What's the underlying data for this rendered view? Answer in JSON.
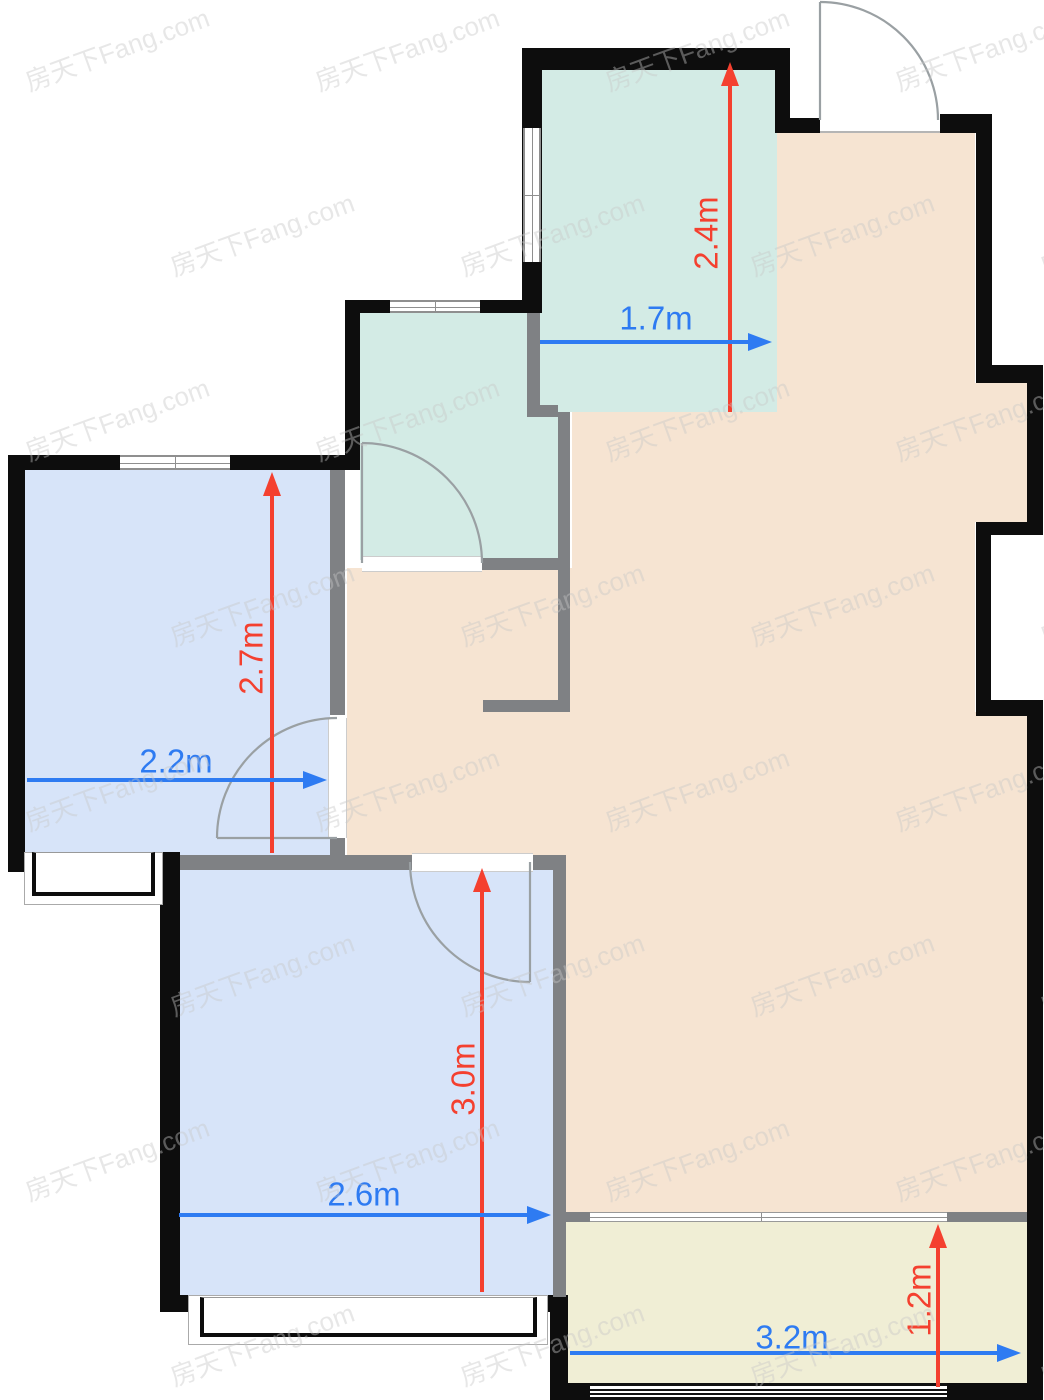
{
  "canvas": {
    "width": 1044,
    "height": 1400,
    "background": "#ffffff"
  },
  "palette": {
    "floor_blue": "#d7e4f9",
    "floor_teal": "#d3ebe5",
    "floor_beige": "#f6e4d2",
    "floor_yellow": "#f0eed5",
    "wall_black": "#0d0d0d",
    "wall_gray": "#7f8184",
    "frame_gray": "#8f8f8f",
    "door_gray": "#9aa0a3",
    "dim_red": "#f4402f",
    "dim_blue": "#2e7bf2"
  },
  "watermark": {
    "text": "房天下Fang.com",
    "font_size": 26,
    "color": "#c8c8c8",
    "opacity": 0.42,
    "rotation_deg": -20,
    "cols": [
      20,
      310,
      600,
      890
    ],
    "rows": [
      30,
      215,
      400,
      585,
      770,
      955,
      1140,
      1325
    ],
    "odd_row_offset": 145
  },
  "rooms": [
    {
      "name": "kitchen",
      "fill": "floor_teal",
      "rects": [
        [
          542,
          70,
          235,
          342
        ]
      ]
    },
    {
      "name": "bathroom",
      "fill": "floor_teal",
      "rects": [
        [
          360,
          313,
          198,
          247
        ]
      ]
    },
    {
      "name": "bedroom-left",
      "fill": "floor_blue",
      "rects": [
        [
          25,
          470,
          305,
          385
        ]
      ]
    },
    {
      "name": "bedroom-bottom",
      "fill": "floor_blue",
      "rects": [
        [
          180,
          870,
          373,
          425
        ]
      ]
    },
    {
      "name": "living-hall",
      "fill": "floor_beige",
      "rects": [
        [
          777,
          133,
          198,
          279
        ],
        [
          975,
          383,
          52,
          139
        ],
        [
          572,
          412,
          403,
          300
        ],
        [
          347,
          568,
          225,
          289
        ],
        [
          566,
          712,
          461,
          500
        ]
      ]
    },
    {
      "name": "balcony",
      "fill": "floor_yellow",
      "rects": [
        [
          566,
          1222,
          461,
          163
        ]
      ]
    }
  ],
  "exterior_walls": [
    [
      522,
      48,
      268,
      22
    ],
    [
      775,
      48,
      15,
      85
    ],
    [
      790,
      118,
      30,
      15
    ],
    [
      940,
      114,
      52,
      19
    ],
    [
      976,
      118,
      16,
      252
    ],
    [
      976,
      365,
      67,
      18
    ],
    [
      1027,
      383,
      16,
      152
    ],
    [
      976,
      522,
      67,
      13
    ],
    [
      976,
      535,
      15,
      165
    ],
    [
      976,
      700,
      67,
      16
    ],
    [
      1027,
      700,
      16,
      700
    ],
    [
      522,
      48,
      20,
      265
    ],
    [
      345,
      300,
      197,
      13
    ],
    [
      345,
      300,
      15,
      170
    ],
    [
      8,
      455,
      352,
      15
    ],
    [
      8,
      455,
      17,
      417
    ],
    [
      8,
      852,
      52,
      18
    ],
    [
      160,
      852,
      20,
      460
    ],
    [
      160,
      1295,
      40,
      17
    ],
    [
      537,
      1295,
      29,
      17
    ],
    [
      550,
      1295,
      18,
      105
    ],
    [
      550,
      1383,
      40,
      17
    ],
    [
      947,
      1383,
      96,
      17
    ]
  ],
  "interior_walls": [
    [
      330,
      470,
      15,
      245
    ],
    [
      330,
      838,
      15,
      19
    ],
    [
      180,
      855,
      232,
      15
    ],
    [
      533,
      855,
      22,
      15
    ],
    [
      482,
      558,
      88,
      12
    ],
    [
      558,
      412,
      12,
      300
    ],
    [
      483,
      700,
      87,
      12
    ],
    [
      527,
      313,
      13,
      95
    ],
    [
      527,
      405,
      31,
      12
    ],
    [
      553,
      855,
      13,
      442
    ],
    [
      566,
      1212,
      24,
      10
    ],
    [
      947,
      1212,
      80,
      10
    ]
  ],
  "door_openings": [
    {
      "name": "entry-threshold",
      "rect": [
        820,
        114,
        120,
        19
      ],
      "edge": "bottom"
    },
    {
      "name": "bathroom-door-opening",
      "rect": [
        362,
        556,
        120,
        16
      ],
      "edge": "tb"
    },
    {
      "name": "bedroom-left-door-opening",
      "rect": [
        328,
        718,
        19,
        120
      ],
      "edge": "lr"
    },
    {
      "name": "bedroom-bottom-door-opening",
      "rect": [
        412,
        853,
        121,
        19
      ],
      "edge": "tb"
    },
    {
      "name": "balcony-slider-opening",
      "rect": [
        590,
        1212,
        357,
        10
      ],
      "edge": "slider"
    }
  ],
  "windows": [
    {
      "name": "bedroom-left-window",
      "rect": [
        120,
        455,
        110,
        15
      ],
      "orient": "h"
    },
    {
      "name": "bathroom-window",
      "rect": [
        390,
        300,
        90,
        13
      ],
      "orient": "h"
    },
    {
      "name": "kitchen-window",
      "rect": [
        523,
        128,
        18,
        134
      ],
      "orient": "v"
    },
    {
      "name": "balcony-window",
      "rect": [
        590,
        1383,
        357,
        17
      ],
      "orient": "h3"
    }
  ],
  "bay_windows": [
    {
      "name": "bedroom-left-bay-window",
      "outer": [
        24,
        852,
        139,
        53
      ],
      "inner": [
        32,
        852,
        123,
        44
      ]
    },
    {
      "name": "bedroom-bottom-bay-window",
      "outer": [
        188,
        1295,
        360,
        50
      ],
      "inner": [
        200,
        1297,
        337,
        40
      ]
    }
  ],
  "doors": [
    {
      "name": "entry-door",
      "leaf": "M820 2 L820 120",
      "arc": "M820 2 A118 118 0 0 1 938 120"
    },
    {
      "name": "bathroom-door",
      "leaf": "M362 563 L362 443",
      "arc": "M362 443 A120 120 0 0 1 482 563"
    },
    {
      "name": "bedroom-left-door",
      "leaf": "M337 838 L217 838",
      "arc": "M337 718 A120 120 0 0 0 217 838"
    },
    {
      "name": "bedroom-bottom-door",
      "leaf": "M530 862 L530 982",
      "arc": "M410 862 A120 120 0 0 0 530 982"
    }
  ],
  "dims": [
    {
      "label": "2.4m",
      "color": "red",
      "dir": "v",
      "x": 730,
      "y1": 62,
      "y2": 412,
      "lx": 706,
      "ly": 233
    },
    {
      "label": "1.7m",
      "color": "blue",
      "dir": "h",
      "y": 342,
      "x1": 540,
      "x2": 772,
      "lx": 656,
      "ly": 318
    },
    {
      "label": "2.7m",
      "color": "red",
      "dir": "v",
      "x": 272,
      "y1": 472,
      "y2": 853,
      "lx": 251,
      "ly": 658
    },
    {
      "label": "2.2m",
      "color": "blue",
      "dir": "h",
      "y": 780,
      "x1": 27,
      "x2": 327,
      "lx": 176,
      "ly": 761
    },
    {
      "label": "3.0m",
      "color": "red",
      "dir": "v",
      "x": 482,
      "y1": 868,
      "y2": 1292,
      "lx": 463,
      "ly": 1079
    },
    {
      "label": "2.6m",
      "color": "blue",
      "dir": "h",
      "y": 1215,
      "x1": 179,
      "x2": 551,
      "lx": 364,
      "ly": 1194
    },
    {
      "label": "3.2m",
      "color": "blue",
      "dir": "h",
      "y": 1353,
      "x1": 570,
      "x2": 1021,
      "lx": 792,
      "ly": 1337
    },
    {
      "label": "1.2m",
      "color": "red",
      "dir": "v",
      "x": 938,
      "y1": 1224,
      "y2": 1387,
      "lx": 919,
      "ly": 1300
    }
  ]
}
